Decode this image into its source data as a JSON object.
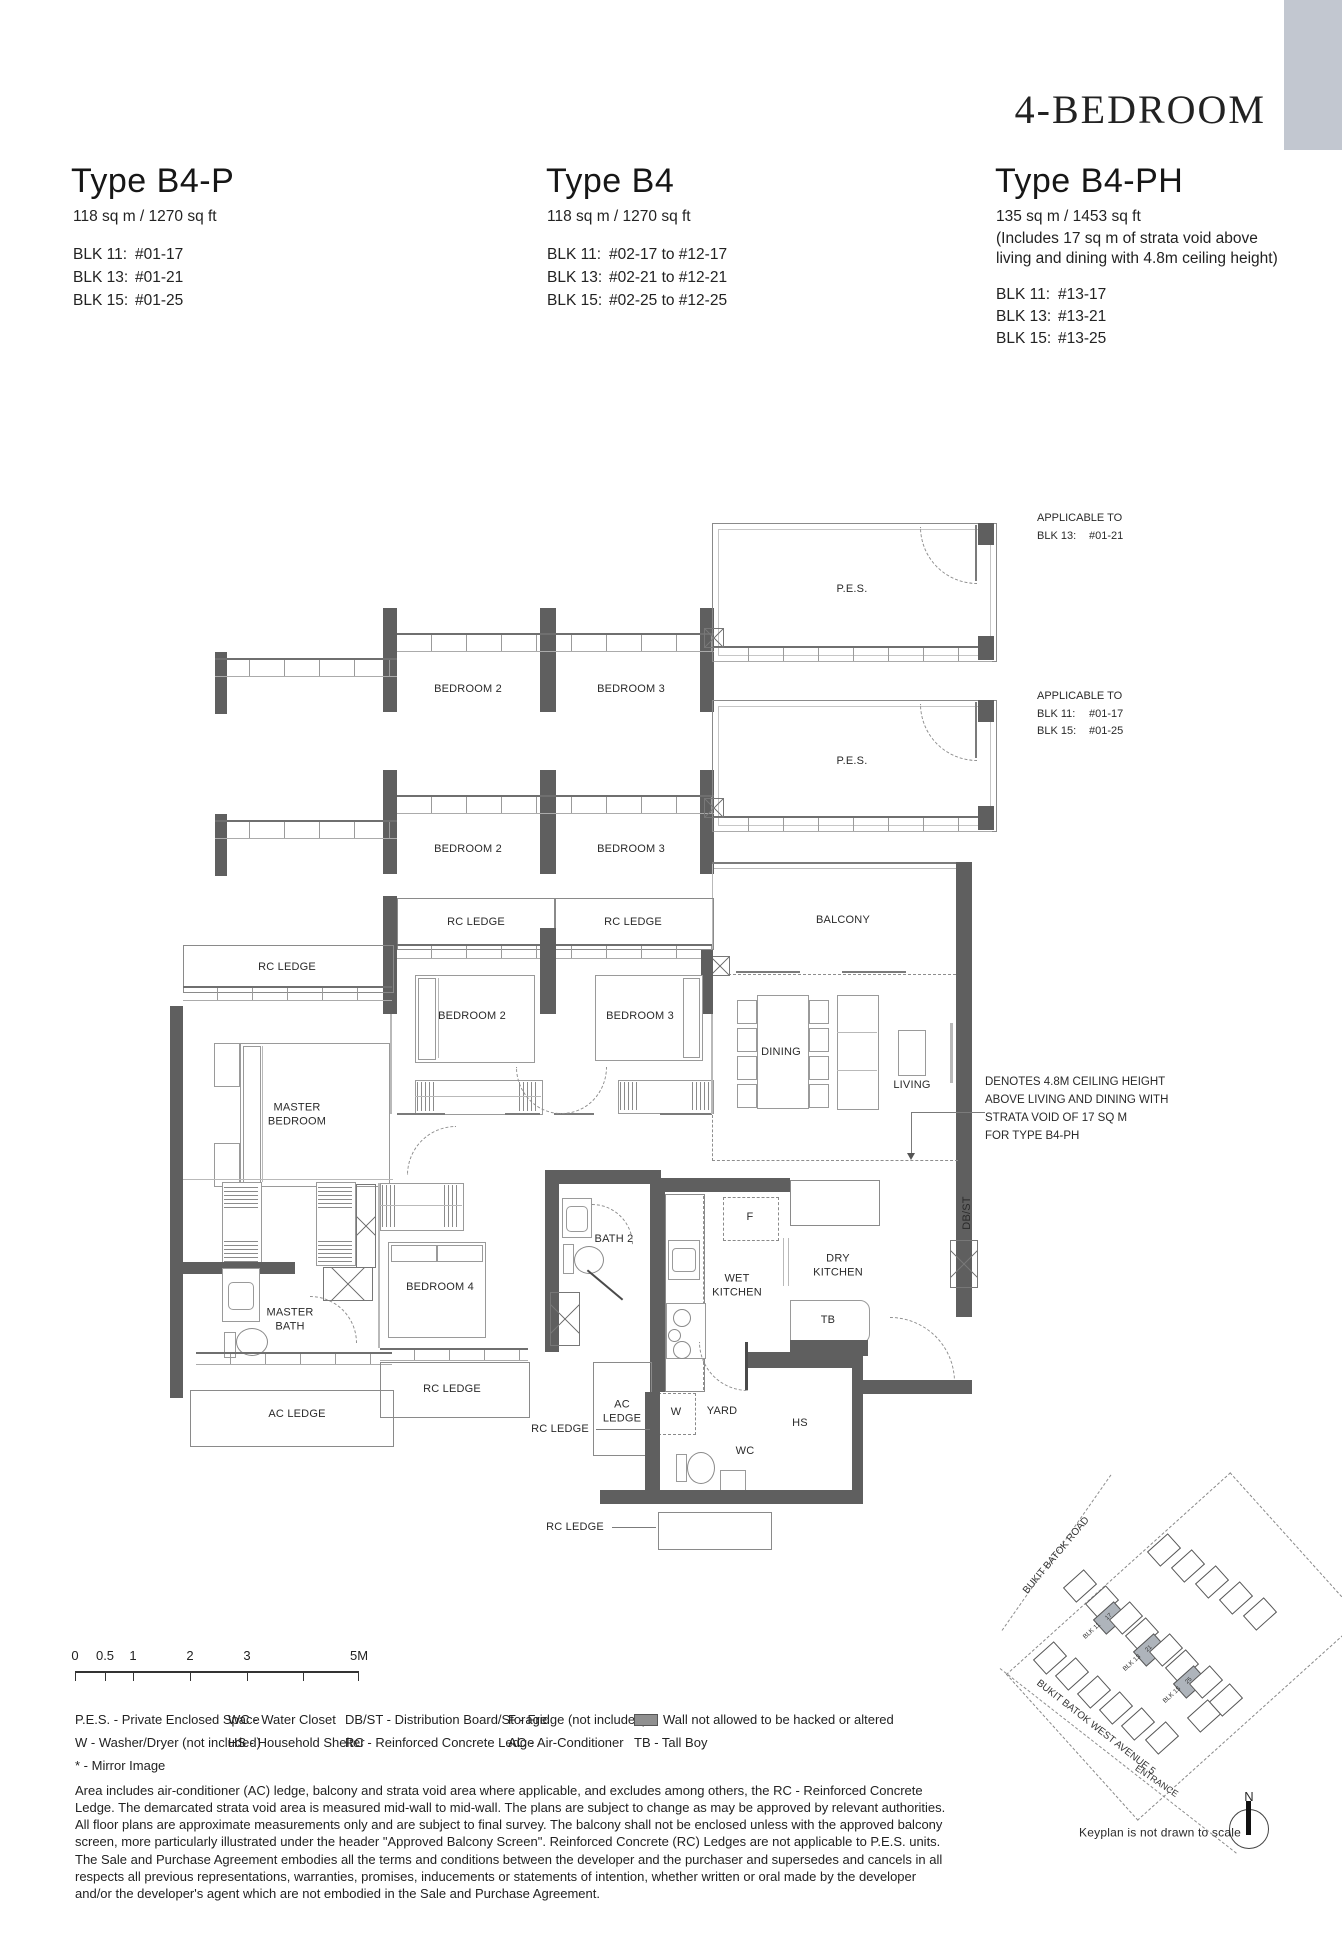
{
  "header": {
    "category": "4-BEDROOM",
    "units": [
      {
        "name": "Type B4-P",
        "area": "118 sq m / 1270 sq ft",
        "blocks": [
          {
            "b": "BLK 11:",
            "v": "#01-17"
          },
          {
            "b": "BLK 13:",
            "v": "#01-21"
          },
          {
            "b": "BLK 15:",
            "v": "#01-25"
          }
        ]
      },
      {
        "name": "Type B4",
        "area": "118 sq m / 1270 sq ft",
        "blocks": [
          {
            "b": "BLK 11:",
            "v": "#02-17 to #12-17"
          },
          {
            "b": "BLK 13:",
            "v": "#02-21 to #12-21"
          },
          {
            "b": "BLK 15:",
            "v": "#02-25 to #12-25"
          }
        ]
      },
      {
        "name": "Type B4-PH",
        "area": "135 sq m / 1453 sq ft",
        "area_note1": "(Includes 17 sq m of strata void above",
        "area_note2": "living and dining with 4.8m ceiling height)",
        "blocks": [
          {
            "b": "BLK 11:",
            "v": "#13-17"
          },
          {
            "b": "BLK 13:",
            "v": "#13-21"
          },
          {
            "b": "BLK 15:",
            "v": "#13-25"
          }
        ]
      }
    ]
  },
  "applicable": [
    {
      "title": "APPLICABLE TO",
      "lines": [
        {
          "b": "BLK 13:",
          "v": "#01-21"
        }
      ]
    },
    {
      "title": "APPLICABLE TO",
      "lines": [
        {
          "b": "BLK 11:",
          "v": "#01-17"
        },
        {
          "b": "BLK 15:",
          "v": "#01-25"
        }
      ]
    }
  ],
  "labels": {
    "pes": "P.E.S.",
    "bedroom2": "BEDROOM 2",
    "bedroom3": "BEDROOM 3",
    "bedroom4": "BEDROOM 4",
    "master_bedroom": "MASTER BEDROOM",
    "master_bath": "MASTER BATH",
    "bath2": "BATH 2",
    "rc_ledge": "RC LEDGE",
    "ac_ledge": "AC LEDGE",
    "balcony": "BALCONY",
    "dining": "DINING",
    "living": "LIVING",
    "wet_kitchen": "WET KITCHEN",
    "dry_kitchen": "DRY KITCHEN",
    "yard": "YARD",
    "hs": "HS",
    "wc": "WC",
    "w": "W",
    "f": "F",
    "tb": "TB",
    "dbst": "DB/ST"
  },
  "ceiling_note": {
    "l1": "DENOTES 4.8M CEILING HEIGHT",
    "l2": "ABOVE LIVING AND DINING WITH",
    "l3": "STRATA VOID OF 17 SQ M",
    "l4": "FOR TYPE B4-PH"
  },
  "scalebar": {
    "t0": "0",
    "t05": "0.5",
    "t1": "1",
    "t2": "2",
    "t3": "3",
    "t5": "5M"
  },
  "legend": {
    "pes": "P.E.S. - Private Enclosed Space",
    "wc": "WC - Water Closet",
    "dbst": "DB/ST - Distribution Board/Storage",
    "f": "F - Fridge (not included)",
    "wall": "Wall not allowed to be hacked or altered",
    "w": "W - Washer/Dryer (not included)",
    "hs": "HS - Household Shelter",
    "rc": "RC - Reinforced Concrete Ledge",
    "ac": "AC - Air-Conditioner",
    "tb": "TB - Tall Boy",
    "mirror": "* - Mirror Image"
  },
  "disclaimer": "Area includes air-conditioner (AC) ledge, balcony and strata void area where applicable, and excludes among others, the RC - Reinforced Concrete Ledge. The demarcated strata void area is measured mid-wall to mid-wall. The plans are subject to change as may be approved by relevant authorities. All floor plans are approximate measurements only and are subject to final survey. The balcony shall not be enclosed unless with the approved balcony screen, more particularly illustrated under the header \"Approved Balcony Screen\". Reinforced Concrete (RC) Ledges are not applic­able to P.E.S. units. The Sale and Purchase Agreement embodies all the terms and conditions between the developer and the purchaser and supersedes and cancels in all respects all previous representations, warranties, promises, inducements or statements of intention, whether written or oral made by the developer and/or the developer's agent which are not embodied in the Sale and Purchase Agreement.",
  "keyplan": {
    "road1": "BUKIT BATOK ROAD",
    "road2": "BUKIT BATOK WEST AVENUE 5",
    "entrance": "ENTRANCE",
    "north": "N",
    "caption": "Keyplan is not drawn to scale",
    "blk11": "BLK 11",
    "blk13": "BLK 13",
    "blk15": "BLK 15",
    "u17": "17",
    "u21": "21",
    "u25": "25"
  }
}
